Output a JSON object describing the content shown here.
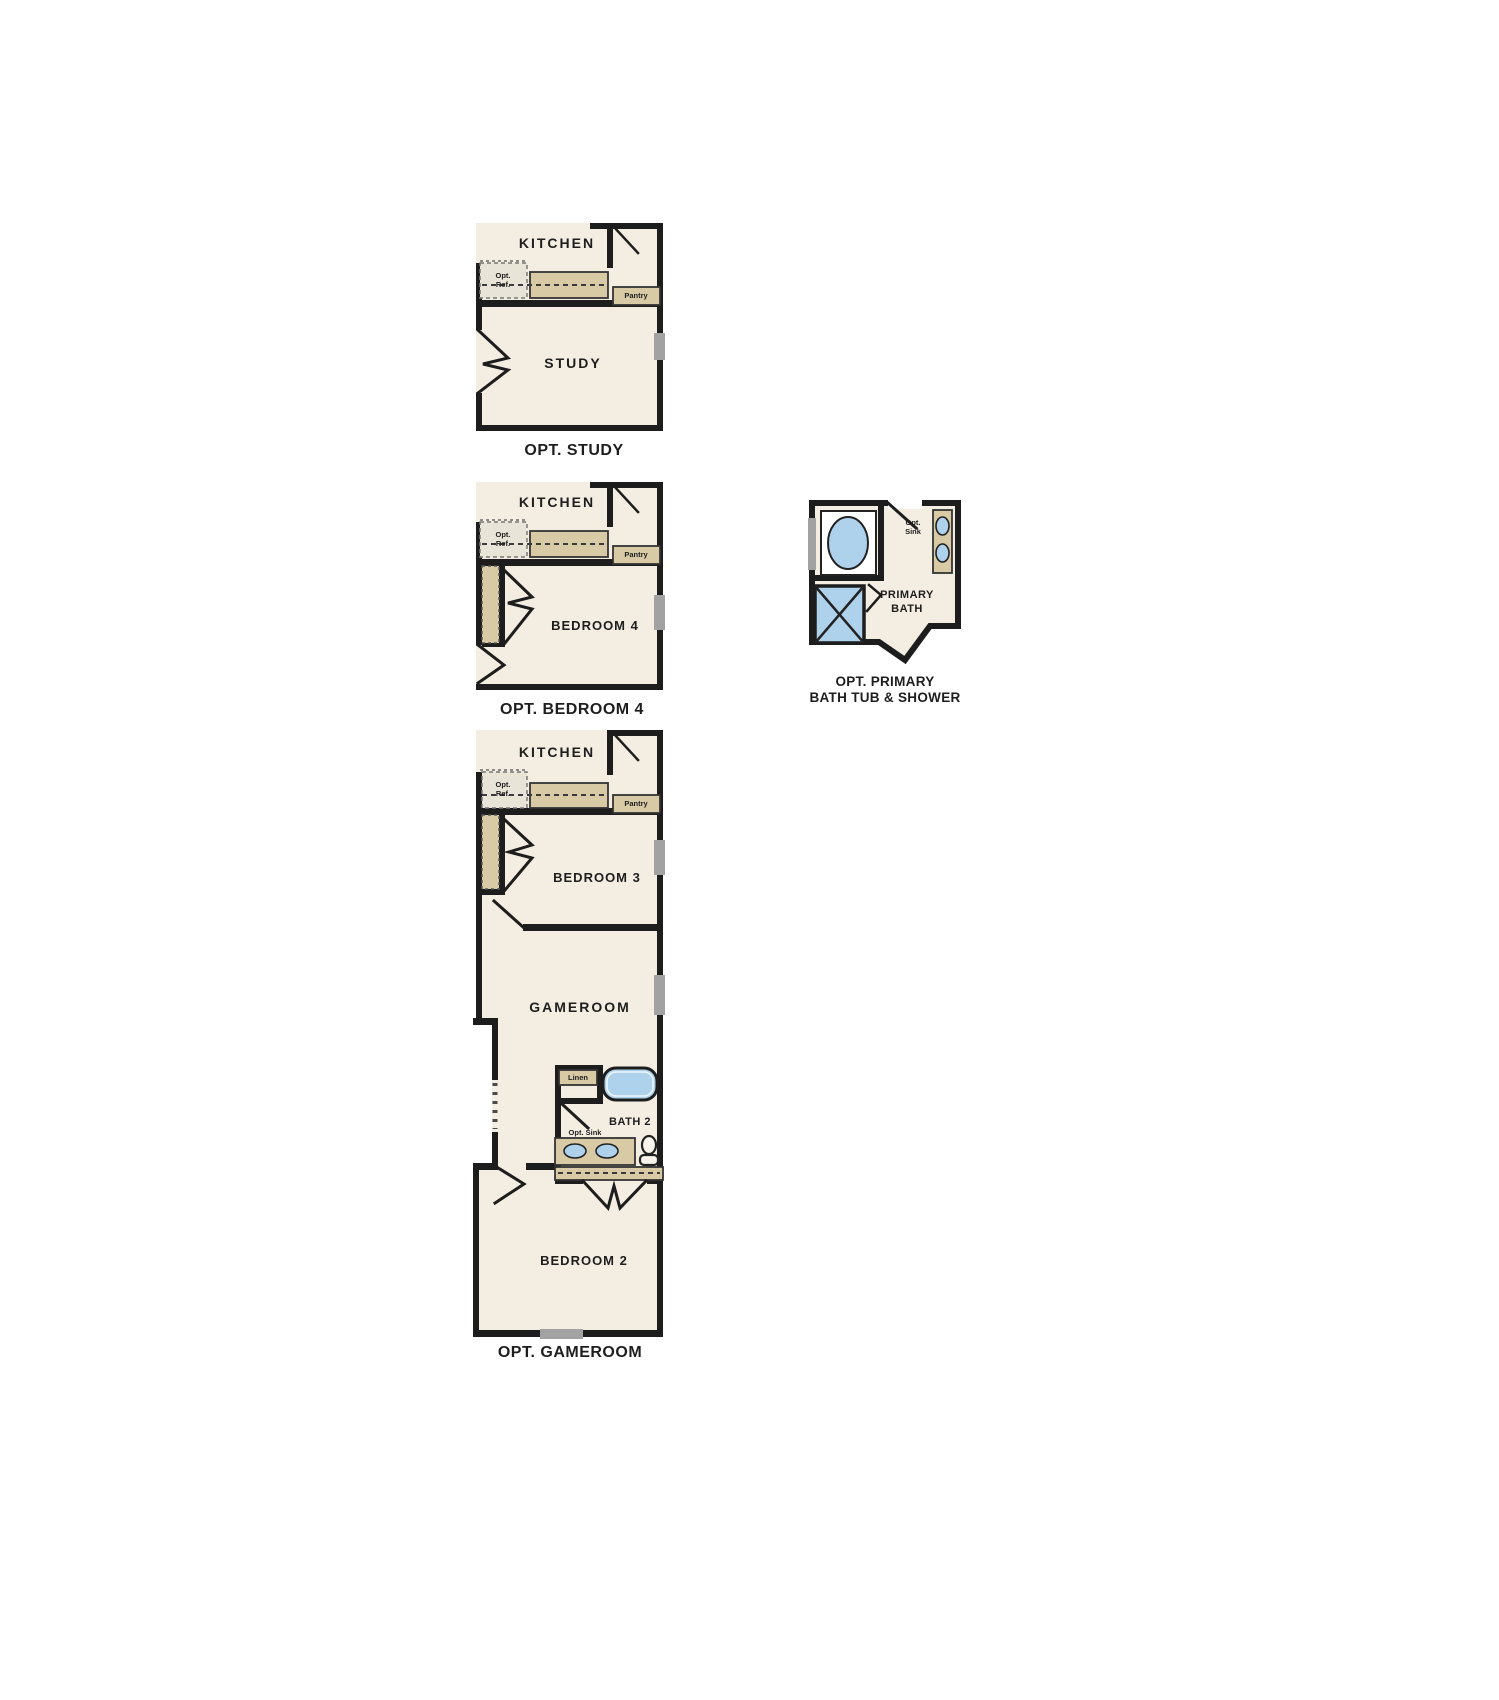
{
  "colors": {
    "background": "#ffffff",
    "floor": "#f4eee2",
    "wall": "#1d1d1d",
    "counter": "#d7caa5",
    "ref_box": "#e9e4d8",
    "fixture_blue": "#aed2ec",
    "window": "#a2a2a2",
    "text": "#1e1e1e"
  },
  "plan_study": {
    "kitchen_label": "KITCHEN",
    "opt_ref_line1": "Opt.",
    "opt_ref_line2": "Ref.",
    "pantry_label": "Pantry",
    "room_label": "STUDY",
    "caption": "OPT. STUDY"
  },
  "plan_bedroom4": {
    "kitchen_label": "KITCHEN",
    "opt_ref_line1": "Opt.",
    "opt_ref_line2": "Ref.",
    "pantry_label": "Pantry",
    "room_label": "BEDROOM 4",
    "caption": "OPT. BEDROOM 4"
  },
  "plan_primary_bath": {
    "opt_sink_line1": "Opt.",
    "opt_sink_line2": "Sink",
    "room_label_line1": "PRIMARY",
    "room_label_line2": "BATH",
    "caption_line1": "OPT. PRIMARY",
    "caption_line2": "BATH TUB & SHOWER"
  },
  "plan_gameroom": {
    "kitchen_label": "KITCHEN",
    "opt_ref_line1": "Opt.",
    "opt_ref_line2": "Ref.",
    "pantry_label": "Pantry",
    "bedroom3_label": "BEDROOM 3",
    "gameroom_label": "GAMEROOM",
    "linen_label": "Linen",
    "bath2_label": "BATH 2",
    "opt_sink_label": "Opt. Sink",
    "bedroom2_label": "BEDROOM 2",
    "caption": "OPT. GAMEROOM"
  }
}
